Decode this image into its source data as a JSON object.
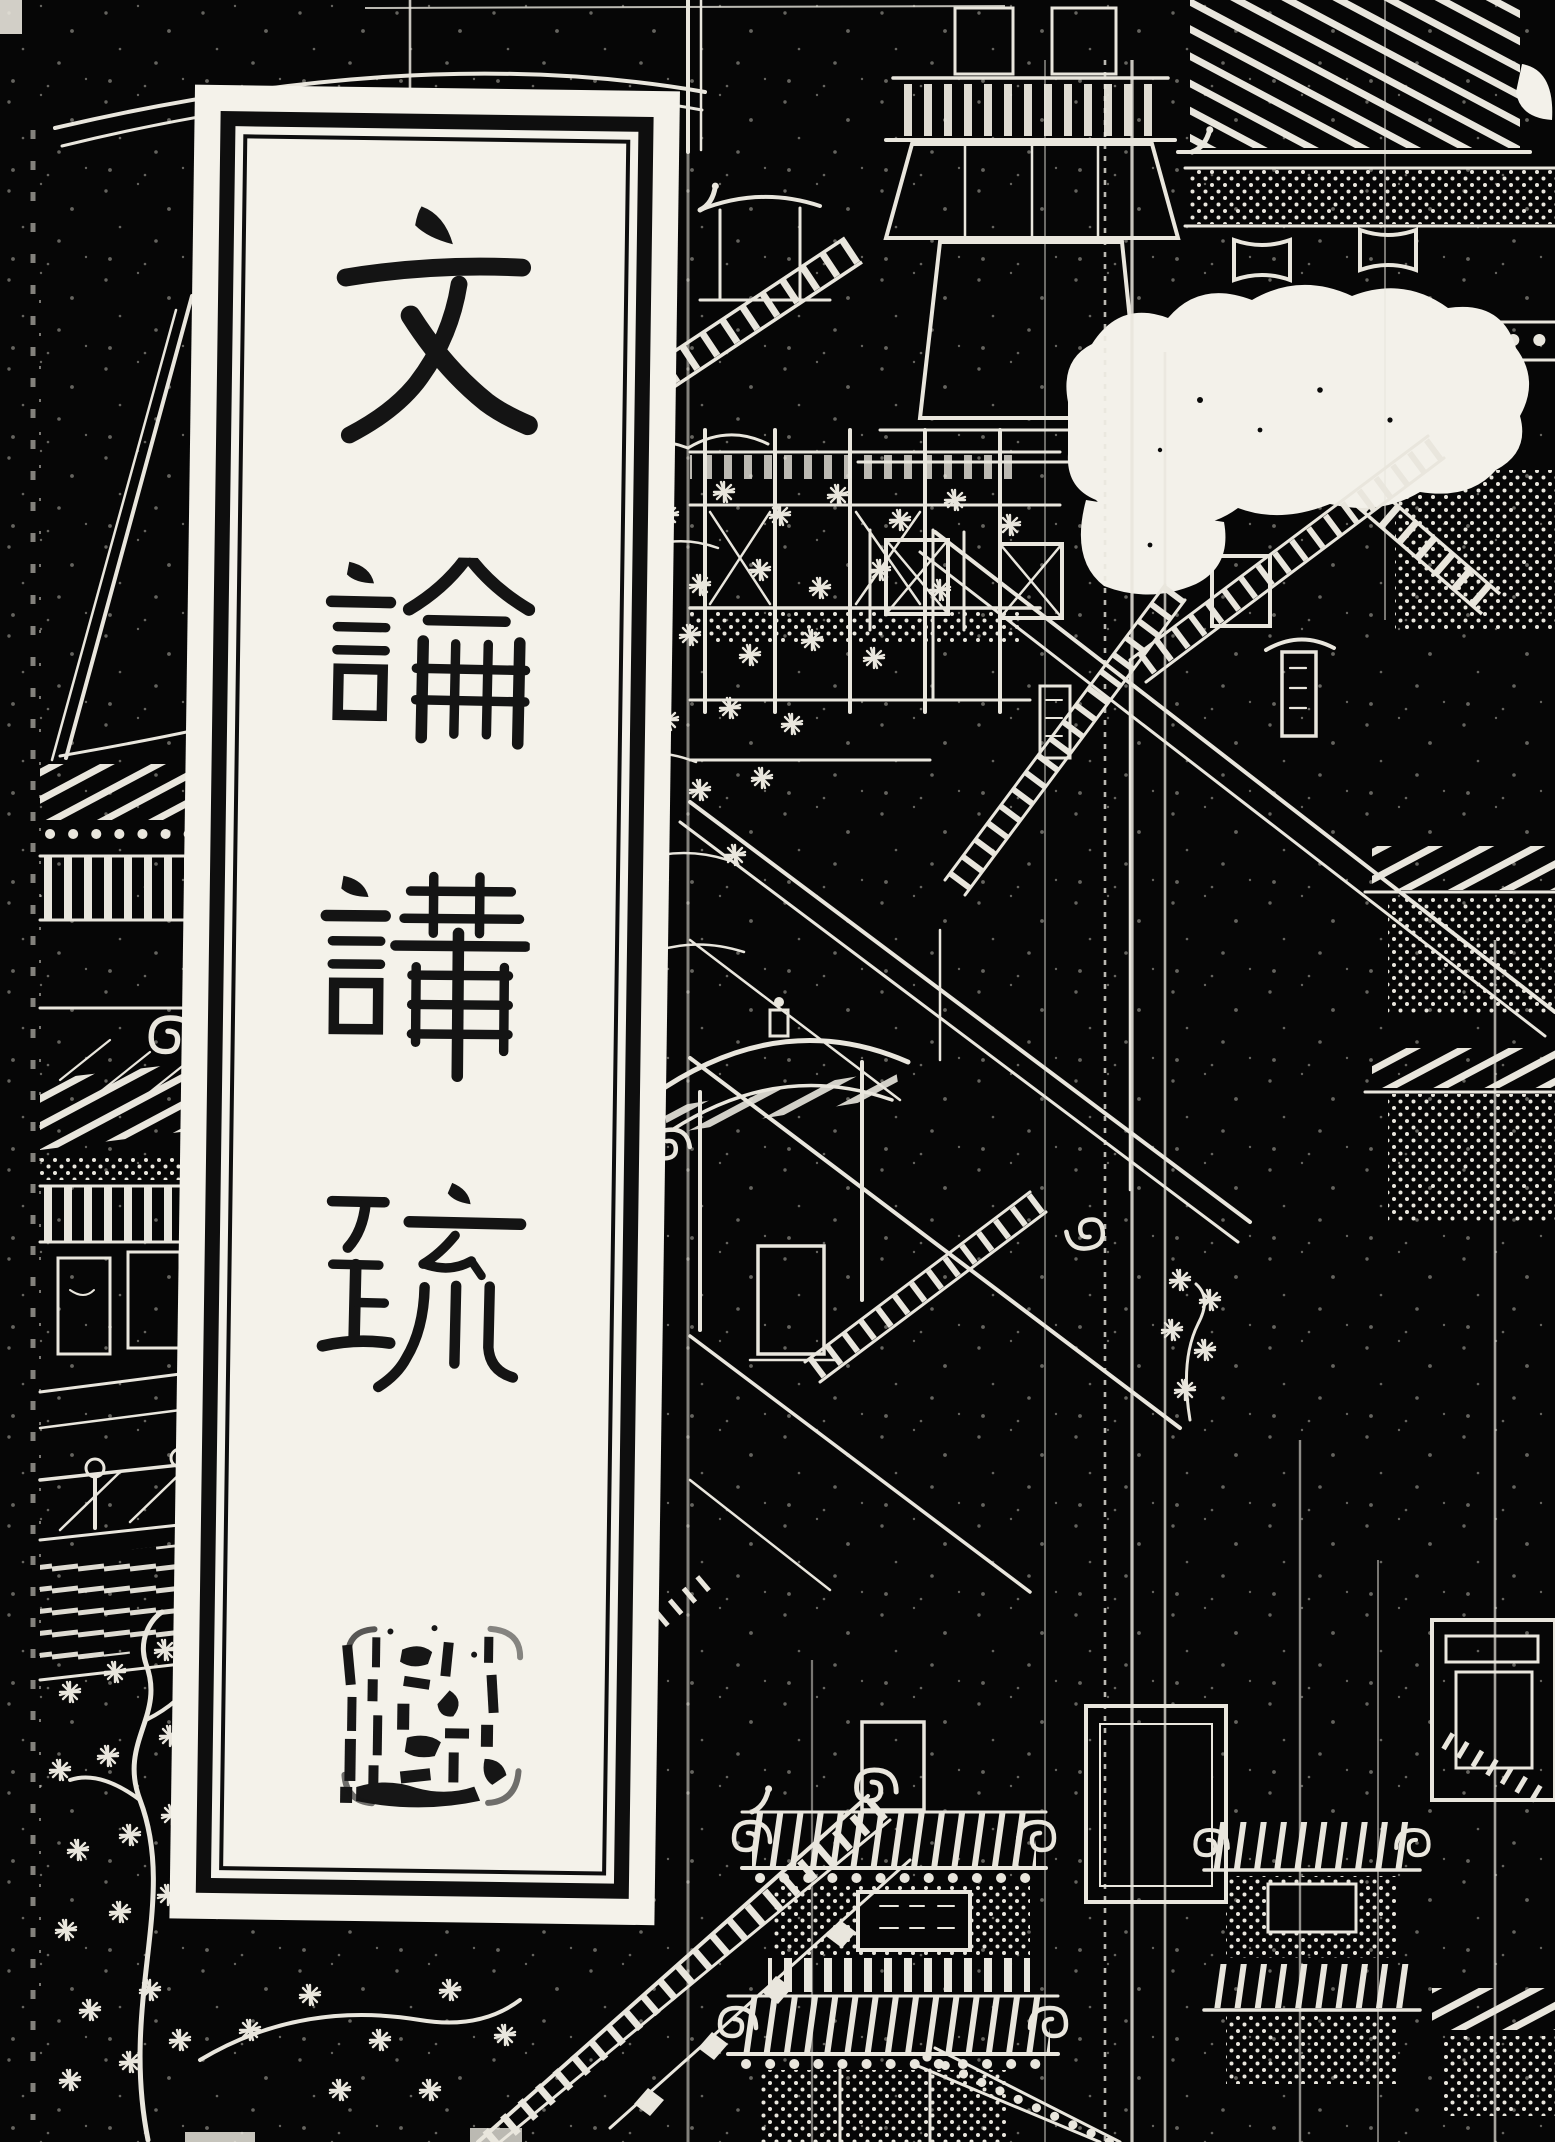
{
  "page": {
    "kind": "scanned traditional Chinese book cover",
    "colors": {
      "background": "#060606",
      "line_art": "#e9e6dd",
      "label_paper": "#f4f2ea",
      "label_border": "#0e0e0e",
      "ink": "#141414",
      "abrasion_blotch": "#f3f1ea"
    }
  },
  "title_label": {
    "title": "文論講疏",
    "characters": [
      "文",
      "論",
      "講",
      "疏"
    ],
    "writing_direction": "vertical, top to bottom",
    "border": "double rule (thick outer, thin inner)",
    "seal": {
      "present": true,
      "shape": "square",
      "legibility": "worn, mostly illegible"
    }
  },
  "background_art": {
    "subject": "bird's-eye woodblock engraving of a palace complex with pavilions, stair ramps, balustrades, lattice walls, rockery and pine trees",
    "style": "white line art on black (negative of woodcut print)",
    "notable_marks": [
      "large white abrasion blotch at upper right",
      "vertical fold creases running down the sheet",
      "tiny illegible characters on pavilion plaques"
    ]
  }
}
